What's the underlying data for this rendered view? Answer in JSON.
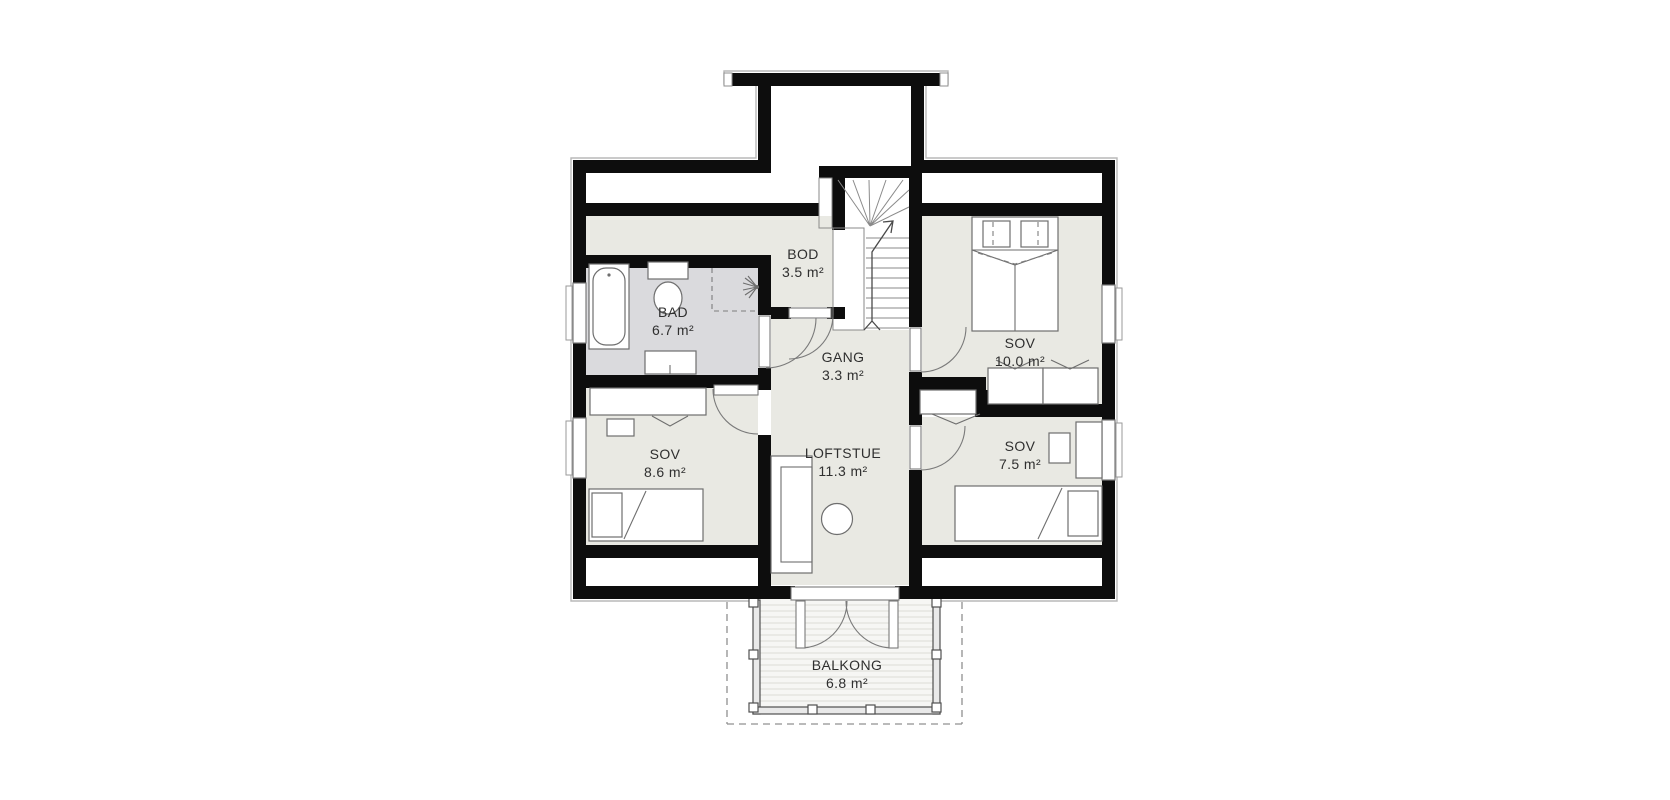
{
  "plan": {
    "type": "floor-plan",
    "rooms": [
      {
        "id": "bad",
        "name": "BAD",
        "area": "6.7 m²"
      },
      {
        "id": "bod",
        "name": "BOD",
        "area": "3.5 m²"
      },
      {
        "id": "gang",
        "name": "GANG",
        "area": "3.3 m²"
      },
      {
        "id": "sov-10",
        "name": "SOV",
        "area": "10.0 m²"
      },
      {
        "id": "sov-8-6",
        "name": "SOV",
        "area": "8.6 m²"
      },
      {
        "id": "loftstue",
        "name": "LOFTSTUE",
        "area": "11.3 m²"
      },
      {
        "id": "sov-7-5",
        "name": "SOV",
        "area": "7.5 m²"
      },
      {
        "id": "balkong",
        "name": "BALKONG",
        "area": "6.8 m²"
      }
    ],
    "fixtures": [
      "bathtub",
      "toilet",
      "shower",
      "sink-vanity",
      "stairs",
      "stairs-up-arrow",
      "double-bed",
      "single-bed",
      "wardrobe",
      "closet",
      "desk",
      "chair",
      "sofa",
      "round-table",
      "balcony-doors",
      "balcony-railing",
      "windows"
    ],
    "colors": {
      "wall": "#0d0d0d",
      "floor": "#e9e9e3",
      "floor_bathroom": "#dadadd",
      "furniture_line": "#6e6e6e",
      "text": "#2f2f2f",
      "background": "#ffffff"
    }
  }
}
